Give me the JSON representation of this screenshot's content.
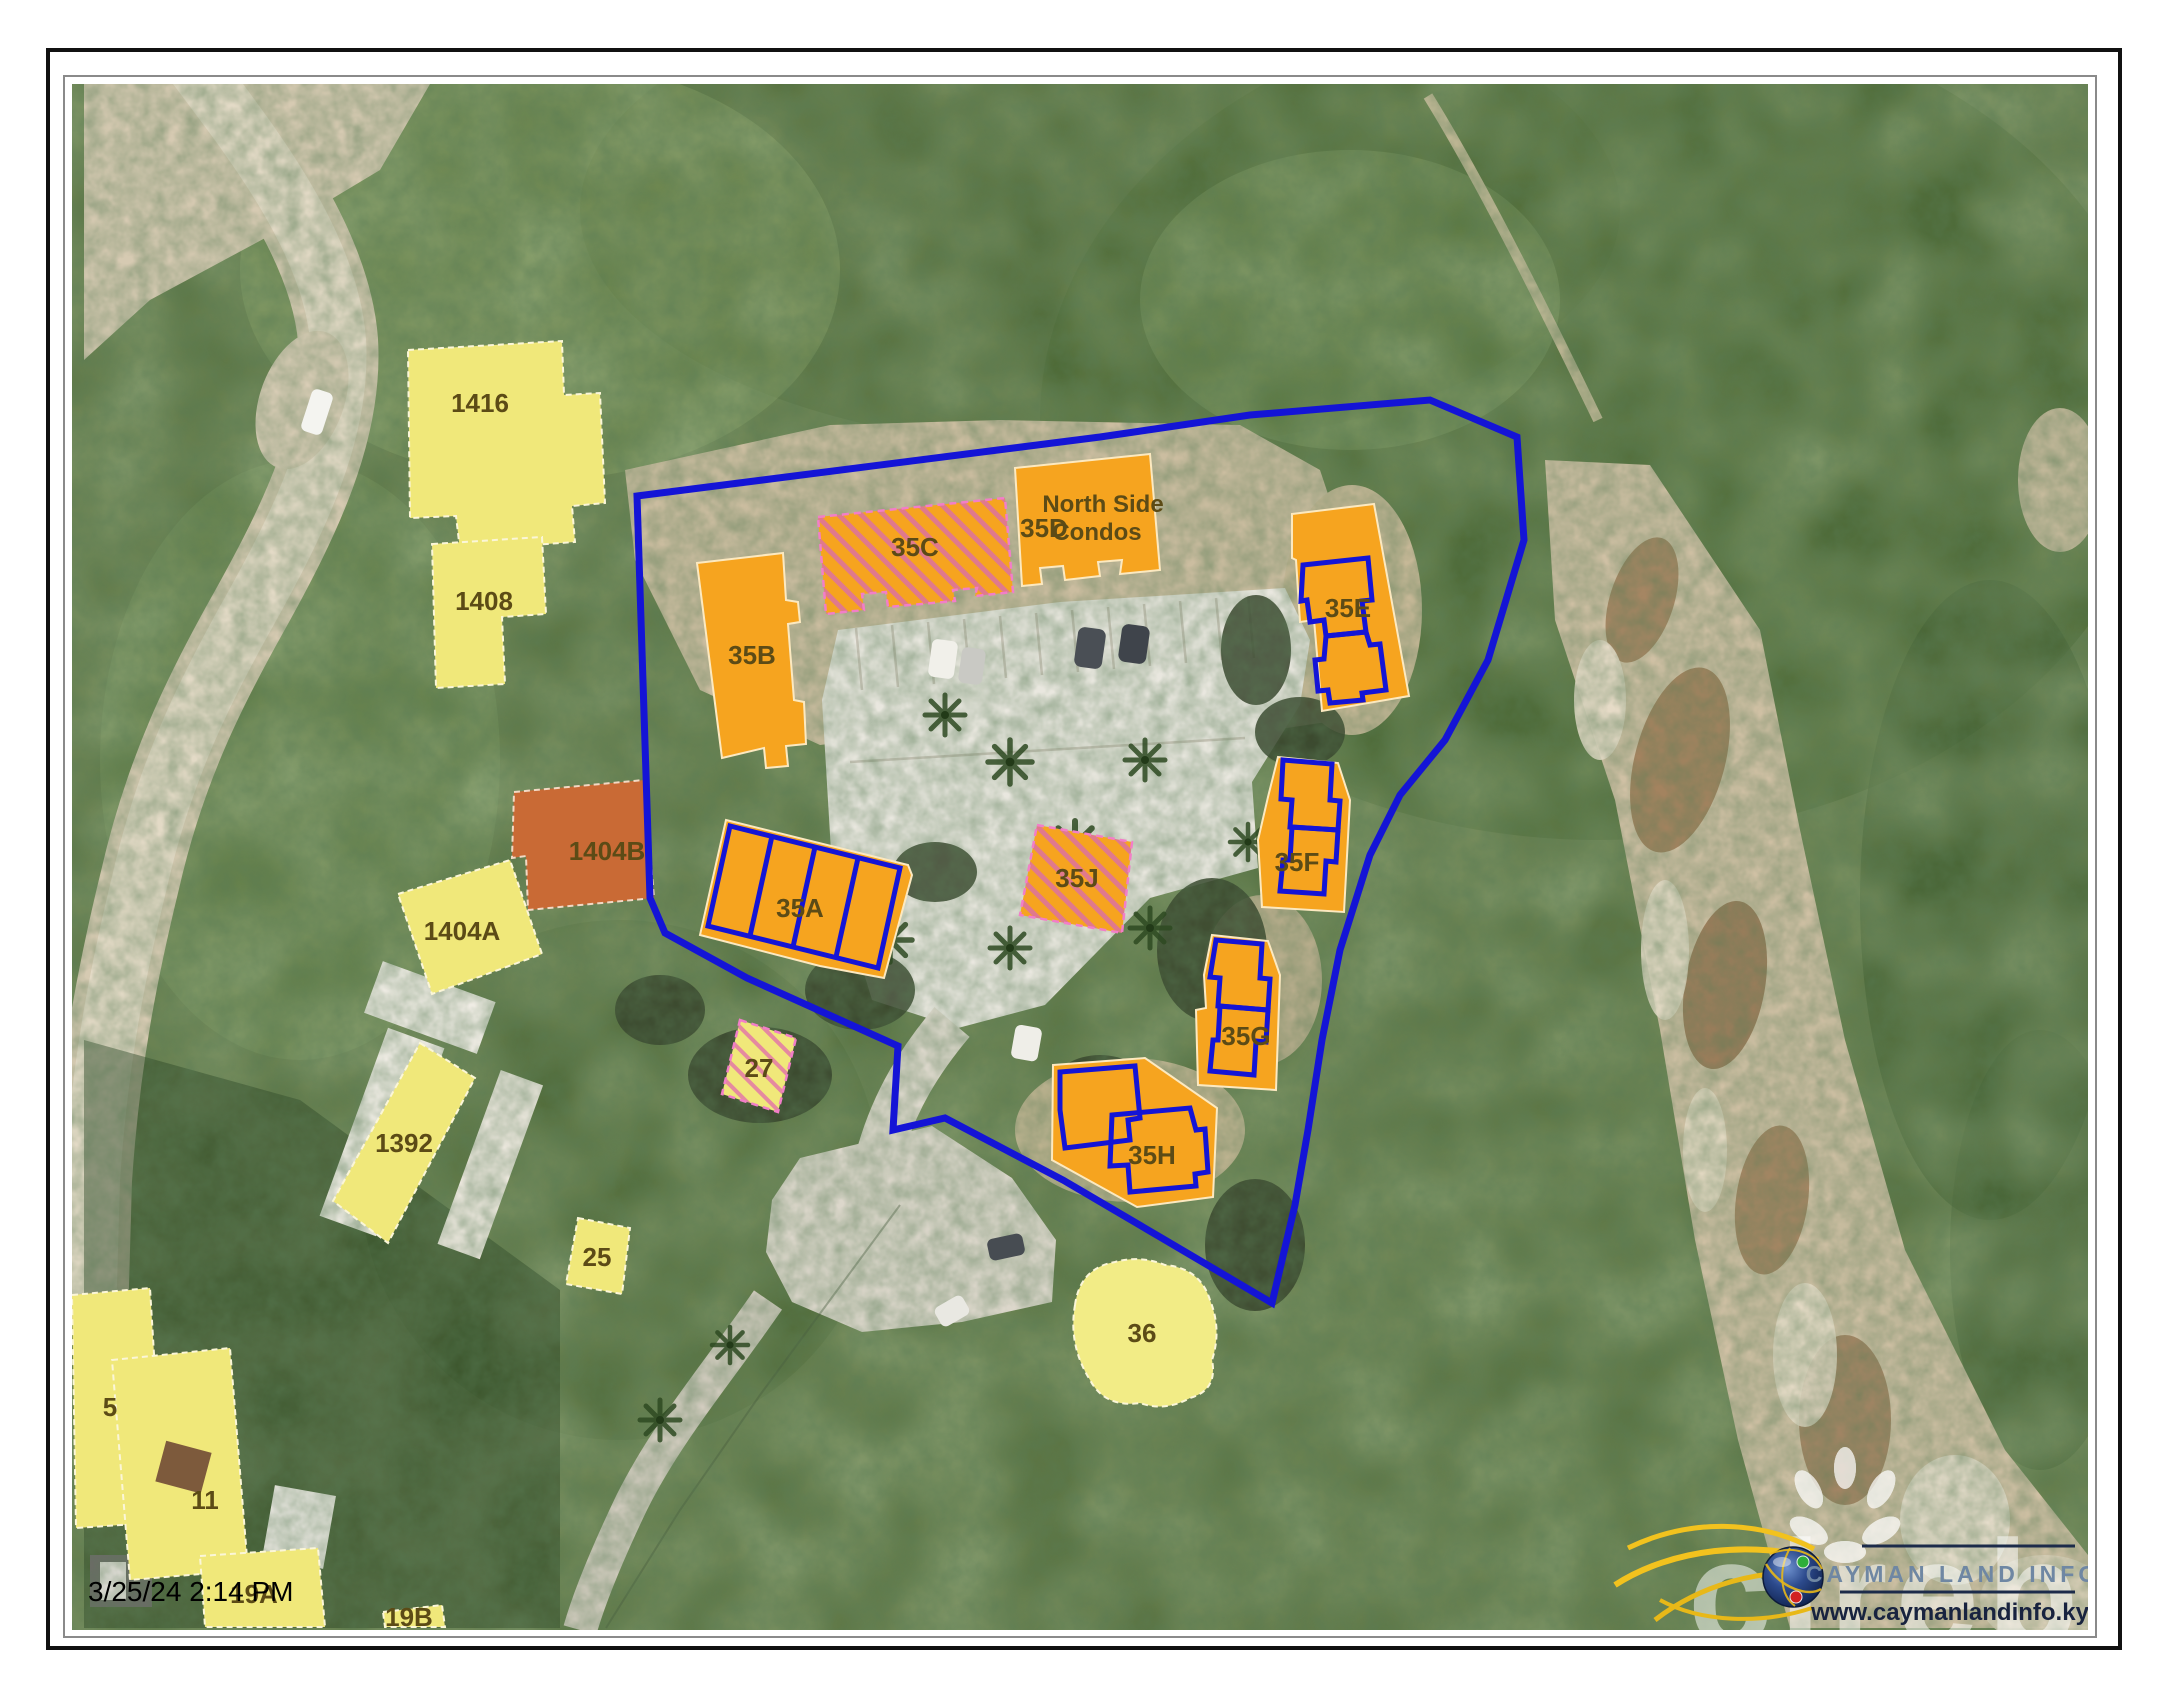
{
  "document": {
    "timestamp": "3/25/24 2:14 PM"
  },
  "map": {
    "complex": {
      "name": "North Side Condos",
      "line1": "North Side",
      "line2": "Condos"
    },
    "parcels": {
      "p1416": "1416",
      "p1408": "1408",
      "p1404a": "1404A",
      "p1392": "1392",
      "p25": "25",
      "p27": "27",
      "p5": "5",
      "p11": "11",
      "p19a": "19A",
      "p19b": "19B",
      "p36": "36"
    },
    "highlighted_parcel": {
      "p1404b": "1404B"
    },
    "buildings": {
      "b35a": "35A",
      "b35b": "35B",
      "b35c": "35C",
      "b35d": "35D",
      "b35e": "35E",
      "b35f": "35F",
      "b35g": "35G",
      "b35h": "35H",
      "b35j": "35J"
    },
    "colors": {
      "boundary_blue": "#1414d6",
      "building_orange": "#f6a41f",
      "parcel_yellow": "#f0e87a",
      "highlight_terracotta": "#c96a35",
      "hatch_pink": "#e0798c"
    }
  },
  "branding": {
    "logo_title": "CAYMAN LAND INFO",
    "logo_url": "www.caymanlandinfo.ky",
    "watermark": "cireba"
  }
}
